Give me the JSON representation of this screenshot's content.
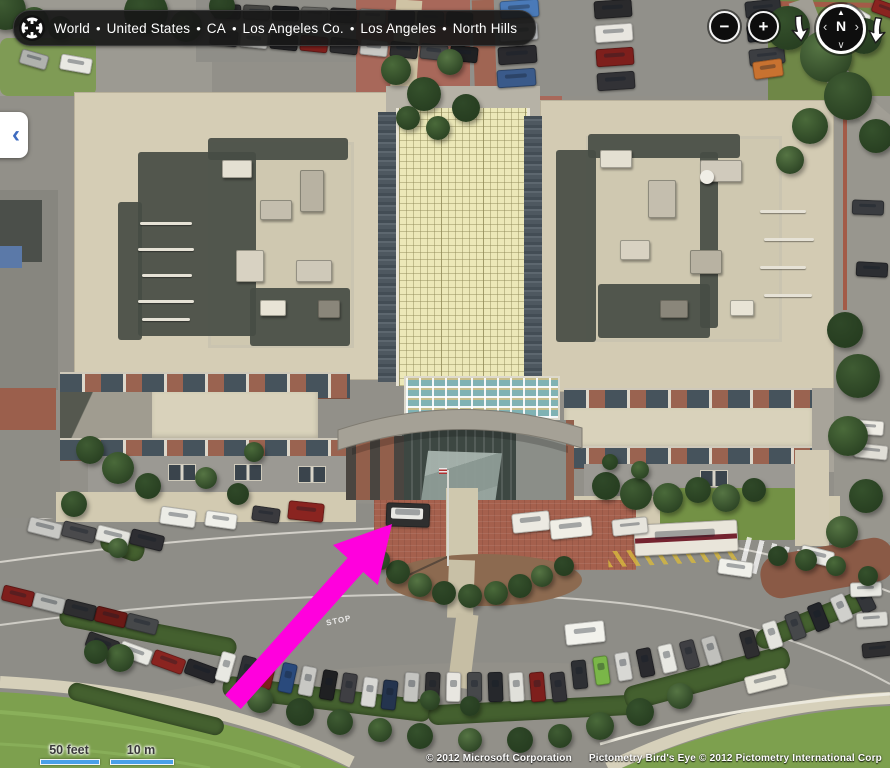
{
  "app": {
    "name": "Bird's Eye aerial map view"
  },
  "breadcrumb": {
    "items": [
      "World",
      "United States",
      "CA",
      "Los Angeles Co.",
      "Los Angeles",
      "North Hills"
    ],
    "separator": "•"
  },
  "controls": {
    "zoom_out": "−",
    "zoom_in": "+",
    "rotate_left_icon": "down-arrow",
    "rotate_right_icon": "down-arrow",
    "compass": {
      "letter": "N",
      "up": "▲",
      "left": "‹",
      "right": "›",
      "down": "∨"
    },
    "pan_left": "‹"
  },
  "scale": {
    "feet_label": "50 feet",
    "metric_label": "10 m"
  },
  "attribution": {
    "microsoft": "© 2012 Microsoft Corporation",
    "pictometry": "Pictometry Bird's Eye © 2012 Pictometry International Corp"
  },
  "road_marking": {
    "stop": "STOP"
  },
  "colors": {
    "annotation_arrow": "#ff00dd",
    "scale_bar": "#4aa0e8",
    "pill_bg": "#1c1c1c",
    "roof_yellow": "#ece8b8",
    "brick": "#9a6350",
    "pan_chevron": "#3f6cc0"
  },
  "scene": {
    "car_rows": [
      {
        "x": 214,
        "y": 4,
        "n": 9,
        "dx": 29,
        "dy": 1,
        "w": 25,
        "h": 13,
        "rot": 3,
        "colors": [
          "#2b2b2d",
          "#474744",
          "#1e1f22",
          "#6a6a66",
          "#2b2b2d",
          "#8a8a86",
          "#26262a",
          "#3a3a3e",
          "#202024"
        ]
      },
      {
        "x": 210,
        "y": 30,
        "n": 9,
        "dx": 30,
        "dy": 2,
        "w": 26,
        "h": 14,
        "rot": 6,
        "colors": [
          "#3a3a3e",
          "#d8d8d4",
          "#232326",
          "#7e1f1c",
          "#2b2b2d",
          "#c8c8c4",
          "#2e2e30",
          "#46484a",
          "#1f2022"
        ]
      },
      {
        "x": 500,
        "y": 0,
        "n": 4,
        "dx": -1,
        "dy": 23,
        "w": 37,
        "h": 16,
        "rot": -4,
        "colors": [
          "#4a7ab8",
          "#c4c6c8",
          "#2a2a2e",
          "#3a5a8a"
        ]
      },
      {
        "x": 594,
        "y": 0,
        "n": 4,
        "dx": 1,
        "dy": 24,
        "w": 36,
        "h": 16,
        "rot": -4,
        "colors": [
          "#2a2a2c",
          "#e8e6e0",
          "#7e1f1c",
          "#323236"
        ]
      },
      {
        "x": 745,
        "y": 0,
        "n": 3,
        "dx": 2,
        "dy": 24,
        "w": 34,
        "h": 15,
        "rot": -6,
        "colors": [
          "#2e3034",
          "#22242a",
          "#3c3e42"
        ]
      },
      {
        "x": 28,
        "y": 520,
        "n": 4,
        "dx": 34,
        "dy": 4,
        "w": 32,
        "h": 14,
        "rot": 14,
        "colors": [
          "#c8c8c4",
          "#4a4a4c",
          "#e4e4de",
          "#2e2e32"
        ]
      },
      {
        "x": 2,
        "y": 588,
        "n": 5,
        "dx": 31,
        "dy": 7,
        "w": 30,
        "h": 14,
        "rot": 14,
        "colors": [
          "#7e1f1c",
          "#b9bab6",
          "#2e2e30",
          "#6a1a16",
          "#46484a"
        ]
      },
      {
        "x": 86,
        "y": 636,
        "n": 4,
        "dx": 33,
        "dy": 9,
        "w": 31,
        "h": 14,
        "rot": 20,
        "colors": [
          "#2e2e30",
          "#e8e8e2",
          "#8a2420",
          "#26262a"
        ]
      },
      {
        "x": 218,
        "y": 652,
        "n": 9,
        "dx": 20.5,
        "dy": 3.5,
        "w": 13,
        "h": 28,
        "rot": 16,
        "drot": -1.2,
        "colors": [
          "#e8e8e2",
          "#2e3034",
          "#7e1f1c",
          "#2a4a7c",
          "#c8c8c4",
          "#1f2022",
          "#3f3f43",
          "#d8d8d4",
          "#24344e"
        ]
      },
      {
        "x": 404,
        "y": 672,
        "n": 8,
        "dx": 21,
        "dy": 0,
        "w": 13,
        "h": 28,
        "rot": 4,
        "drot": -1.5,
        "colors": [
          "#c4c4c0",
          "#2e2e30",
          "#e8e6e0",
          "#46484a",
          "#26282c",
          "#e0e0da",
          "#7e1f1c",
          "#323236"
        ]
      },
      {
        "x": 572,
        "y": 660,
        "n": 7,
        "dx": 22,
        "dy": -4,
        "w": 13,
        "h": 27,
        "rot": -6,
        "drot": -1.8,
        "colors": [
          "#2e3034",
          "#7ab648",
          "#d8d8d4",
          "#2a2a2e",
          "#e8e8e2",
          "#3f3f43",
          "#c0c0bc"
        ]
      },
      {
        "x": 742,
        "y": 630,
        "n": 6,
        "dx": 23,
        "dy": -9,
        "w": 13,
        "h": 26,
        "rot": -16,
        "drot": -2,
        "colors": [
          "#2e2e30",
          "#e4e4de",
          "#46484a",
          "#23252a",
          "#d0d0cc",
          "#34363a"
        ]
      }
    ],
    "vehicles": [
      [
        634,
        522,
        102,
        30,
        -3,
        "#e9e5da",
        null,
        "#74232f"
      ],
      [
        386,
        503,
        42,
        22,
        2,
        "#2f2f2f",
        "#e8e8e4",
        null
      ],
      [
        512,
        512,
        36,
        18,
        -6,
        "#eceae2"
      ],
      [
        550,
        518,
        40,
        18,
        -6,
        "#f0eee6"
      ],
      [
        612,
        518,
        34,
        15,
        -6,
        "#e6e4dc"
      ],
      [
        160,
        508,
        34,
        16,
        8,
        "#ecece6"
      ],
      [
        205,
        512,
        30,
        14,
        8,
        "#f0f0ea"
      ],
      [
        288,
        502,
        34,
        17,
        6,
        "#8a2420"
      ],
      [
        252,
        507,
        26,
        13,
        8,
        "#3a3a3e"
      ],
      [
        753,
        60,
        28,
        16,
        -8,
        "#c87230"
      ],
      [
        60,
        56,
        30,
        14,
        10,
        "#e8e8e2"
      ],
      [
        20,
        52,
        26,
        13,
        16,
        "#b0b2ae"
      ],
      [
        718,
        560,
        33,
        14,
        8,
        "#f0f0ea"
      ],
      [
        800,
        548,
        32,
        14,
        14,
        "#ecece6"
      ],
      [
        745,
        672,
        40,
        16,
        -14,
        "#e8e6da"
      ],
      [
        565,
        622,
        38,
        20,
        -6,
        "#f2f2ec"
      ],
      [
        850,
        582,
        30,
        13,
        -2,
        "#e8e8e2"
      ],
      [
        856,
        612,
        30,
        13,
        -4,
        "#dcdcd6"
      ],
      [
        862,
        642,
        30,
        13,
        -6,
        "#2e2e30"
      ],
      [
        850,
        420,
        32,
        13,
        4,
        "#eeece4"
      ],
      [
        854,
        444,
        32,
        13,
        6,
        "#e0ded6"
      ],
      [
        852,
        200,
        30,
        13,
        2,
        "#3a3c40"
      ],
      [
        856,
        262,
        30,
        13,
        3,
        "#2c2e32"
      ],
      [
        842,
        8,
        26,
        13,
        30,
        "#e8e8e2"
      ],
      [
        872,
        2,
        24,
        12,
        20,
        "#8a2420"
      ]
    ],
    "trees": [
      [
        6,
        10,
        20
      ],
      [
        34,
        22,
        15
      ],
      [
        146,
        12,
        22
      ],
      [
        186,
        26,
        16
      ],
      [
        222,
        6,
        13
      ],
      [
        60,
        28,
        12
      ],
      [
        396,
        70,
        15
      ],
      [
        424,
        94,
        17
      ],
      [
        450,
        62,
        13
      ],
      [
        466,
        108,
        14
      ],
      [
        408,
        118,
        12
      ],
      [
        438,
        128,
        12
      ],
      [
        788,
        28,
        22
      ],
      [
        826,
        56,
        26
      ],
      [
        864,
        36,
        18
      ],
      [
        848,
        96,
        24
      ],
      [
        810,
        126,
        18
      ],
      [
        876,
        136,
        17
      ],
      [
        790,
        160,
        14
      ],
      [
        845,
        330,
        18
      ],
      [
        858,
        376,
        22
      ],
      [
        848,
        436,
        20
      ],
      [
        866,
        496,
        17
      ],
      [
        842,
        532,
        16
      ],
      [
        606,
        486,
        14
      ],
      [
        636,
        494,
        16
      ],
      [
        668,
        498,
        15
      ],
      [
        698,
        490,
        13
      ],
      [
        726,
        498,
        14
      ],
      [
        754,
        490,
        12
      ],
      [
        90,
        450,
        14
      ],
      [
        118,
        468,
        16
      ],
      [
        148,
        486,
        13
      ],
      [
        206,
        478,
        11
      ],
      [
        238,
        494,
        11
      ],
      [
        74,
        504,
        13
      ],
      [
        254,
        452,
        10
      ],
      [
        398,
        572,
        12
      ],
      [
        420,
        585,
        12
      ],
      [
        444,
        593,
        12
      ],
      [
        470,
        596,
        12
      ],
      [
        496,
        593,
        12
      ],
      [
        520,
        586,
        12
      ],
      [
        542,
        576,
        11
      ],
      [
        564,
        566,
        10
      ],
      [
        380,
        560,
        10
      ],
      [
        120,
        658,
        14
      ],
      [
        96,
        652,
        12
      ],
      [
        260,
        700,
        13
      ],
      [
        300,
        712,
        14
      ],
      [
        340,
        722,
        13
      ],
      [
        380,
        730,
        12
      ],
      [
        420,
        736,
        13
      ],
      [
        470,
        740,
        12
      ],
      [
        520,
        740,
        13
      ],
      [
        560,
        736,
        12
      ],
      [
        600,
        726,
        14
      ],
      [
        640,
        712,
        14
      ],
      [
        680,
        696,
        13
      ],
      [
        470,
        706,
        10
      ],
      [
        430,
        700,
        10
      ],
      [
        640,
        470,
        9
      ],
      [
        610,
        462,
        8
      ],
      [
        118,
        548,
        10
      ],
      [
        778,
        556,
        10
      ],
      [
        806,
        560,
        11
      ],
      [
        836,
        566,
        10
      ],
      [
        868,
        576,
        10
      ]
    ],
    "tree_colors": [
      "#3f5c33",
      "#4a6a3a",
      "#35512c",
      "#567544",
      "#2f4828"
    ],
    "hedges": [
      [
        58,
        622,
        180,
        20,
        11
      ],
      [
        222,
        688,
        210,
        22,
        7
      ],
      [
        428,
        700,
        210,
        20,
        -3
      ],
      [
        622,
        666,
        170,
        24,
        -15
      ],
      [
        66,
        700,
        160,
        18,
        14
      ],
      [
        752,
        610,
        120,
        20,
        -22
      ],
      [
        100,
        535,
        45,
        22,
        20
      ]
    ],
    "shadows": [
      [
        138,
        152,
        118,
        184
      ],
      [
        250,
        288,
        100,
        58
      ],
      [
        118,
        202,
        24,
        138
      ],
      [
        208,
        138,
        140,
        22
      ],
      [
        556,
        150,
        40,
        192
      ],
      [
        598,
        284,
        112,
        54
      ],
      [
        588,
        134,
        152,
        24
      ],
      [
        700,
        152,
        18,
        176
      ]
    ],
    "roof_blocks": [
      [
        222,
        160,
        28,
        16,
        "#e4e0d2"
      ],
      [
        260,
        200,
        30,
        18,
        "#c4beae"
      ],
      [
        236,
        250,
        26,
        30,
        "#d8d2c2"
      ],
      [
        300,
        170,
        22,
        40,
        "#b8b2a2"
      ],
      [
        296,
        260,
        34,
        20,
        "#cfc9b9"
      ],
      [
        318,
        300,
        20,
        16,
        "#8a867a"
      ],
      [
        260,
        300,
        24,
        14,
        "#e8e4d6"
      ],
      [
        600,
        150,
        30,
        16,
        "#e4e0d2"
      ],
      [
        648,
        180,
        26,
        36,
        "#c4beae"
      ],
      [
        700,
        160,
        40,
        20,
        "#d0cabc"
      ],
      [
        620,
        240,
        28,
        18,
        "#d8d2c2"
      ],
      [
        690,
        250,
        30,
        22,
        "#b8b2a2"
      ],
      [
        730,
        300,
        22,
        14,
        "#e8e4d6"
      ],
      [
        660,
        300,
        26,
        16,
        "#8a867a"
      ]
    ],
    "pipes": [
      [
        140,
        222,
        52
      ],
      [
        138,
        248,
        56
      ],
      [
        142,
        274,
        50
      ],
      [
        138,
        300,
        56
      ],
      [
        142,
        318,
        48
      ],
      [
        760,
        210,
        46
      ],
      [
        764,
        238,
        50
      ],
      [
        760,
        266,
        46
      ],
      [
        764,
        294,
        48
      ]
    ]
  }
}
